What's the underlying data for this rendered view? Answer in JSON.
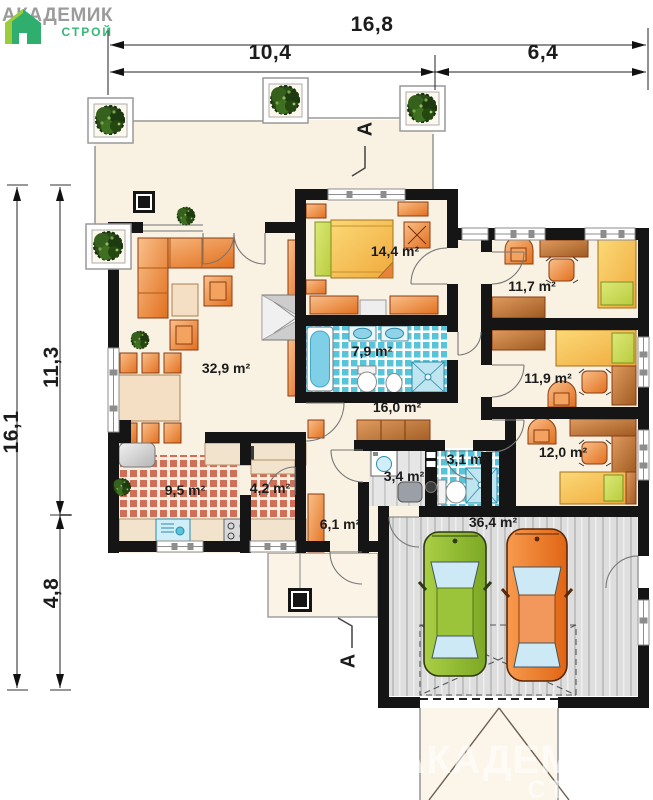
{
  "logo": {
    "brand": "АКАДЕМИК",
    "sub": "СТРОЙ"
  },
  "dimensions": {
    "top_total": "16,8",
    "top_left": "10,4",
    "top_right": "6,4",
    "left_total": "16,1",
    "left_upper": "11,3",
    "left_lower": "4,8"
  },
  "section_marks": {
    "top": "A",
    "bottom": "A"
  },
  "rooms": {
    "living": {
      "area": "32,9 m²"
    },
    "bedroom": {
      "area": "14,4 m²"
    },
    "bathroom_main": {
      "area": "7,9 m²"
    },
    "room_right_1": {
      "area": "11,7 m²"
    },
    "room_right_2": {
      "area": "11,9 m²"
    },
    "room_right_3": {
      "area": "12,0 m²"
    },
    "hall": {
      "area": "16,0 m²"
    },
    "kitchen": {
      "area": "9,5 m²"
    },
    "pantry": {
      "area": "4,2 m²"
    },
    "utility": {
      "area": "3,4 m²"
    },
    "bathroom_small": {
      "area": "3,1 m²"
    },
    "entry": {
      "area": "6,1 m²"
    },
    "garage": {
      "area": "36,4 m²"
    }
  },
  "watermark": {
    "brand": "АКАДЕМИК",
    "sub": "СТРОЙ"
  },
  "colors": {
    "logo_green": "#35b877",
    "logo_gray": "#9b9b9b",
    "wall": "#151515",
    "floor_cream": "#f9f1e2",
    "tile_blue": "#57c4da",
    "tile_red": "#cf6f58",
    "furniture_orange": "#e8833a",
    "bed_yellow": "#f5c04a",
    "car_green": "#8fbc33",
    "car_orange": "#ef8136"
  }
}
